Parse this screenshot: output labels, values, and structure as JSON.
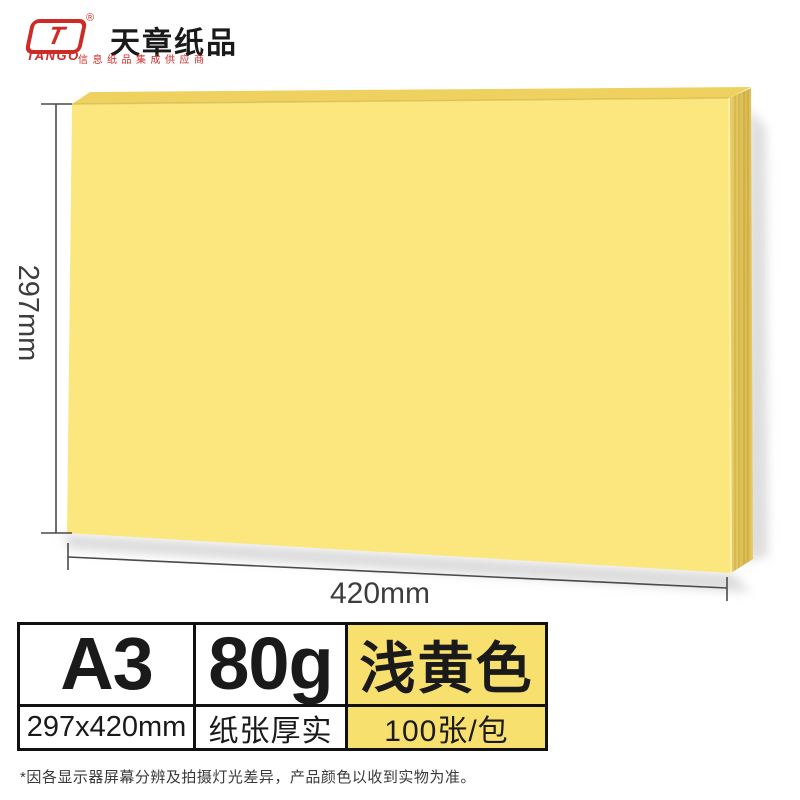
{
  "brand": {
    "logo_letter": "T",
    "logo_name": "TANGO",
    "registered_mark": "®",
    "name": "天章纸品",
    "tagline": "信息纸品集成供应商"
  },
  "dimensions": {
    "height_label": "297mm",
    "width_label": "420mm"
  },
  "spec_table": {
    "size": "A3",
    "size_detail": "297x420mm",
    "weight": "80g",
    "weight_detail": "纸张厚实",
    "color_name": "浅黄色",
    "pack_detail": "100张/包"
  },
  "disclaimer": "*因各显示器屏幕分辨及拍摄灯光差异，产品颜色以收到实物为准。",
  "colors": {
    "brand_red": "#CE2B26",
    "paper_front": "#FBE77E",
    "paper_top": "#EFD160",
    "paper_side_light": "#EACD68",
    "paper_side_dark": "#D9B94D",
    "spec_highlight": "#F8E06E",
    "dimension_line": "#4A4A4A",
    "shadow_gray": "#BDBDBD"
  }
}
